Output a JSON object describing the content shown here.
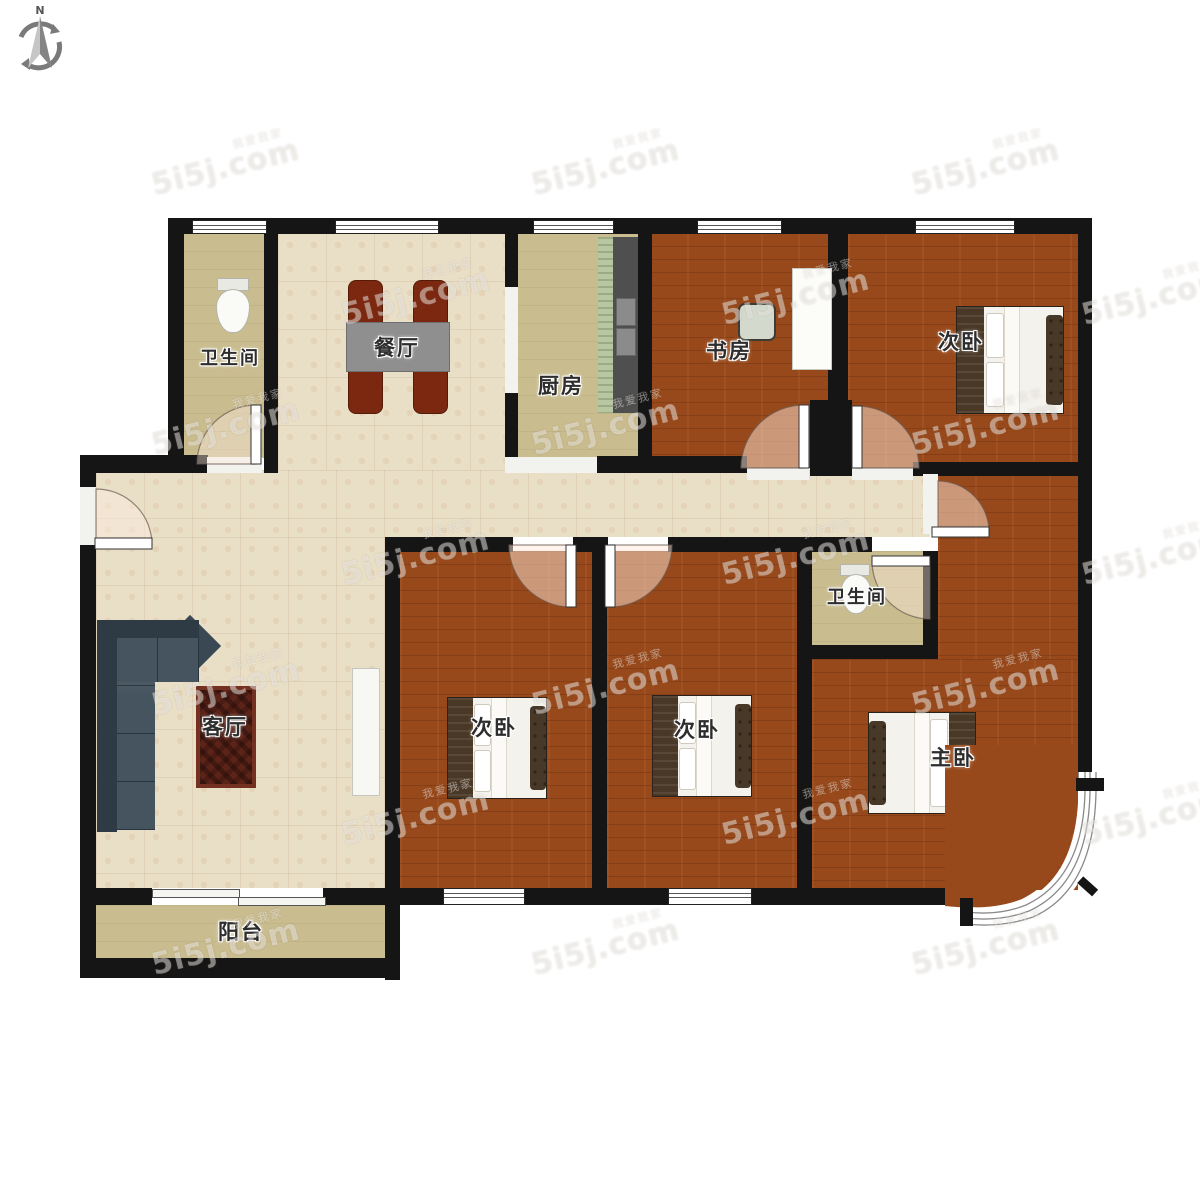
{
  "compass": {
    "north_label": "N"
  },
  "watermark": {
    "brand": "5i5j.com",
    "tagline": "我爱我家"
  },
  "rooms": {
    "bathroom_top": {
      "label": "卫生间"
    },
    "dining": {
      "label": "餐厅"
    },
    "kitchen": {
      "label": "厨房"
    },
    "study": {
      "label": "书房"
    },
    "bedroom_top_right": {
      "label": "次卧"
    },
    "living": {
      "label": "客厅"
    },
    "bedroom_mid": {
      "label": "次卧"
    },
    "bedroom_right": {
      "label": "次卧"
    },
    "bathroom_inner": {
      "label": "卫生间"
    },
    "master_bedroom": {
      "label": "主卧"
    },
    "balcony": {
      "label": "阳台"
    }
  }
}
